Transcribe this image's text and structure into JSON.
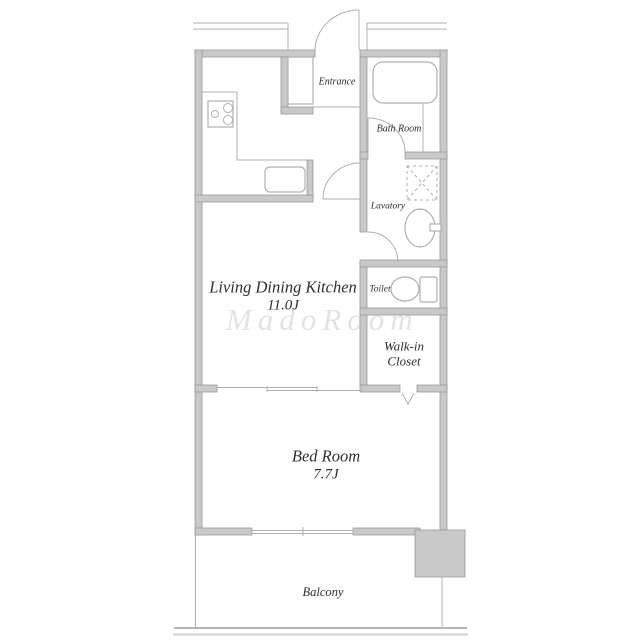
{
  "colors": {
    "wall_fill": "#c9c9c9",
    "wall_stroke": "#9a9a9a",
    "line": "#b0b0b0",
    "text": "#2f2f2f",
    "watermark": "#c3c3c3"
  },
  "rooms": {
    "ldk": {
      "name": "Living Dining Kitchen",
      "size": "11.0J"
    },
    "bedroom": {
      "name": "Bed Room",
      "size": "7.7J"
    },
    "entrance": {
      "name": "Entrance"
    },
    "bathroom": {
      "name": "Bath Room"
    },
    "lavatory": {
      "name": "Lavatory"
    },
    "toilet": {
      "name": "Toilet"
    },
    "walk_in_closet": {
      "name": "Walk-in Closet"
    },
    "balcony": {
      "name": "Balcony"
    }
  },
  "watermark": {
    "text": "MadoRoom"
  },
  "fixtures": [
    "bathtub",
    "stove",
    "kitchen-sink",
    "wash-basin",
    "washing-machine-space",
    "toilet-bowl",
    "shoe-cabinet"
  ]
}
